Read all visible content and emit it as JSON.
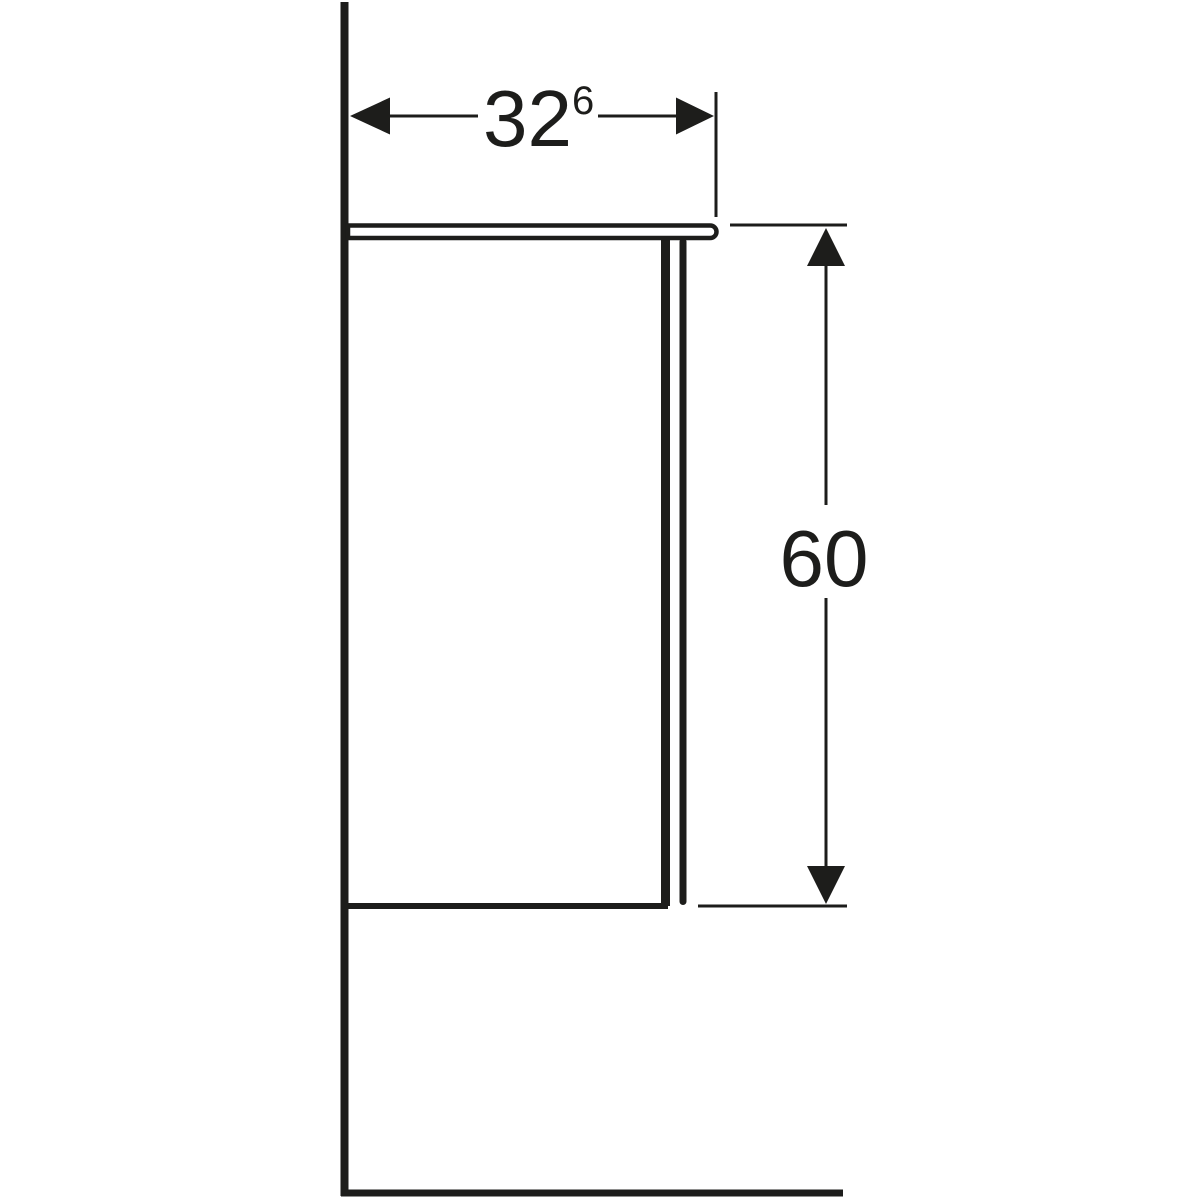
{
  "drawing": {
    "background_color": "#ffffff",
    "line_color": "#1d1d1b",
    "width_dimension": {
      "value": "32",
      "superscript": "6"
    },
    "height_dimension": {
      "value": "60"
    }
  }
}
